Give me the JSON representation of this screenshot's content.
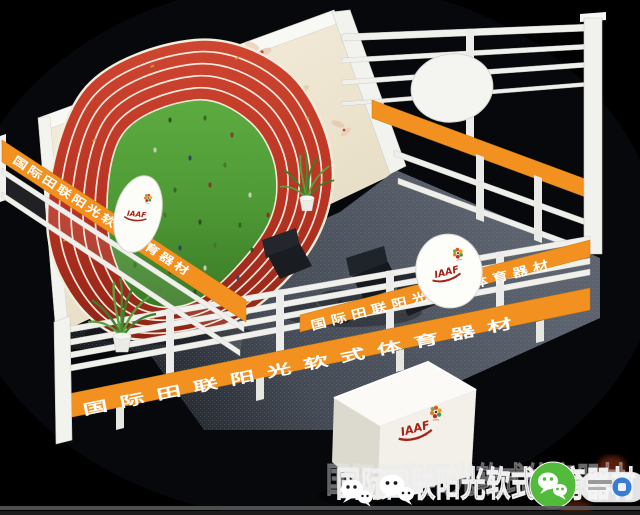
{
  "scene": {
    "title": "exhibition-booth-3d-render"
  },
  "branding": {
    "iaaf_label": "IAAF",
    "banner_text": "国际田联阳光软式体育器材",
    "watermark_text": "国际田联阳光软式体育器材"
  },
  "watermark": {
    "icons": [
      "wechat-icon",
      "wechat-icon",
      "wechat-green-icon",
      "wechat-badge-pill"
    ]
  },
  "colors": {
    "background": "#000000",
    "accent_orange": "#f29120",
    "accent_orange_dark": "#c87a0c",
    "track_red": "#b83322",
    "field_green": "#4f9a36",
    "wall_cream": "#f0e9d6",
    "frame_white": "#f1f1ee",
    "carpet_gray": "#454b55",
    "wechat_green": "#52bb3c",
    "badge_blue": "#3a7bd5"
  }
}
